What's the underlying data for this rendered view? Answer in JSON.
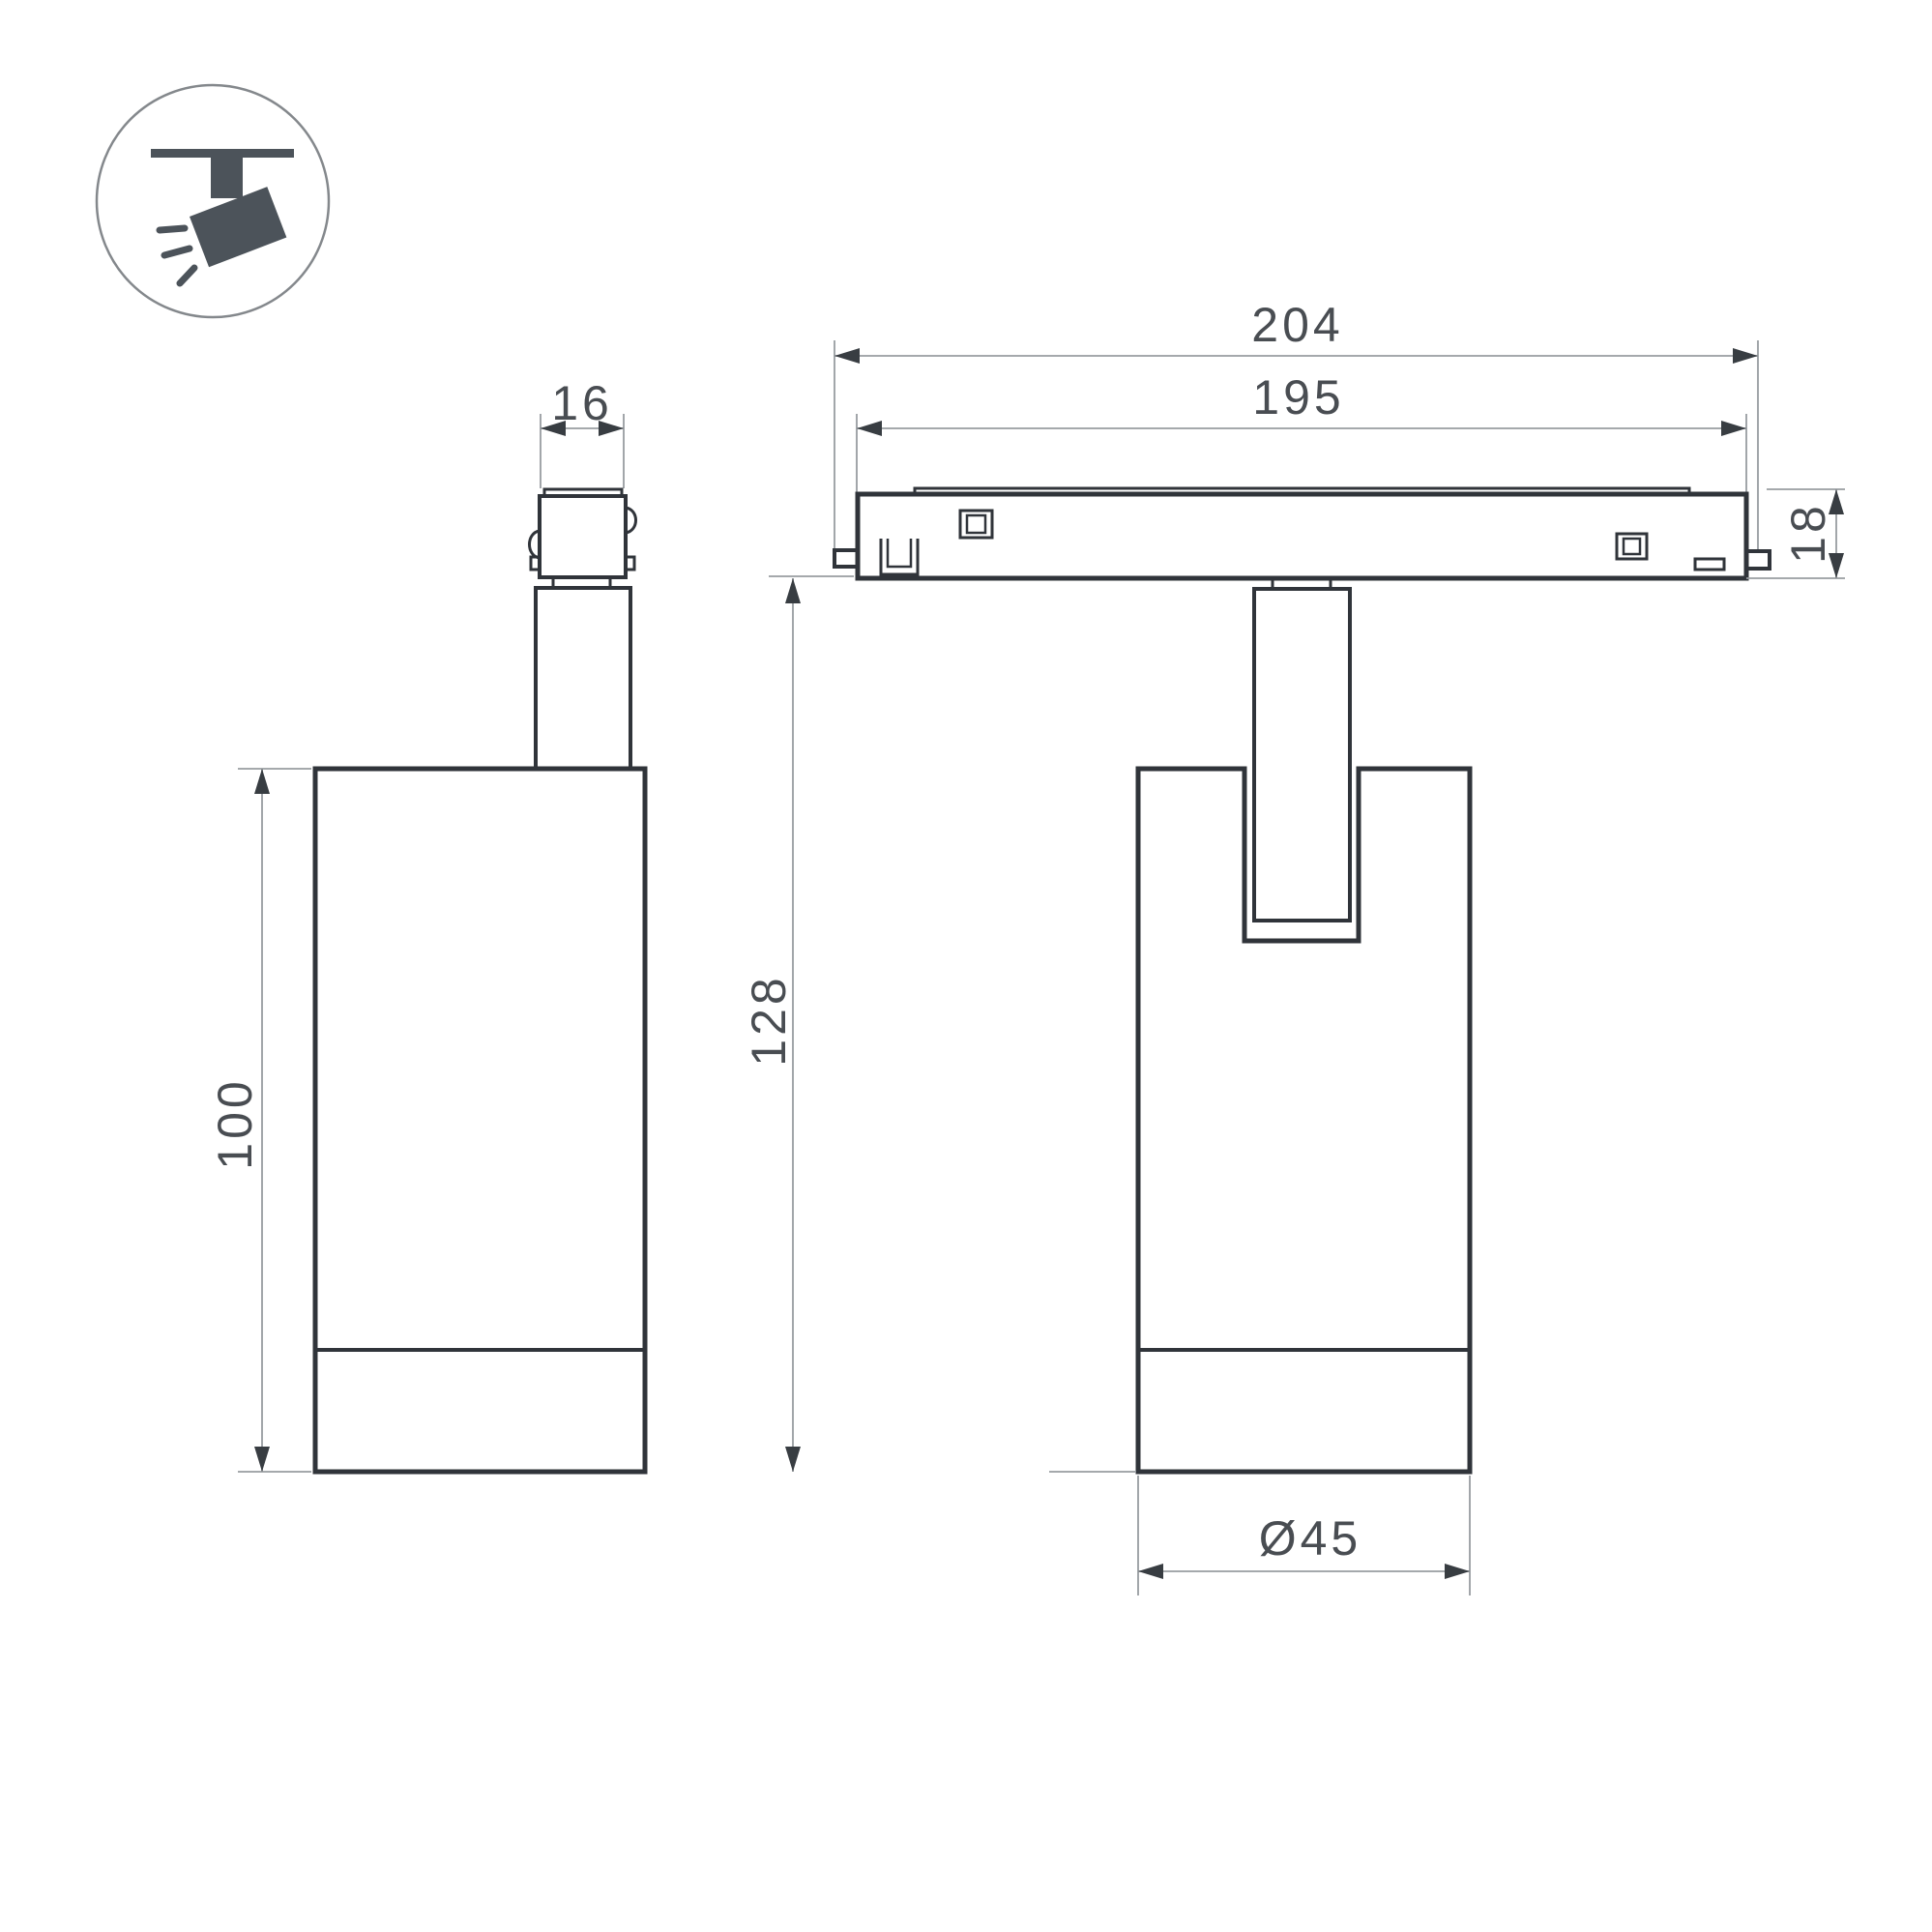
{
  "colors": {
    "background": "#ffffff",
    "outline": "#30343a",
    "dim": "#989da1",
    "arrow": "#383d42",
    "text": "#494d52",
    "icon": "#4c535a",
    "badge_stroke": "#84888c"
  },
  "badge": {
    "icon_name": "track-spotlight-icon"
  },
  "dims": {
    "adapter_width": "16",
    "overall_width": "204",
    "rail_width": "195",
    "rail_height": "18",
    "body_height": "100",
    "overall_height": "128",
    "body_diameter": "Ø45"
  }
}
